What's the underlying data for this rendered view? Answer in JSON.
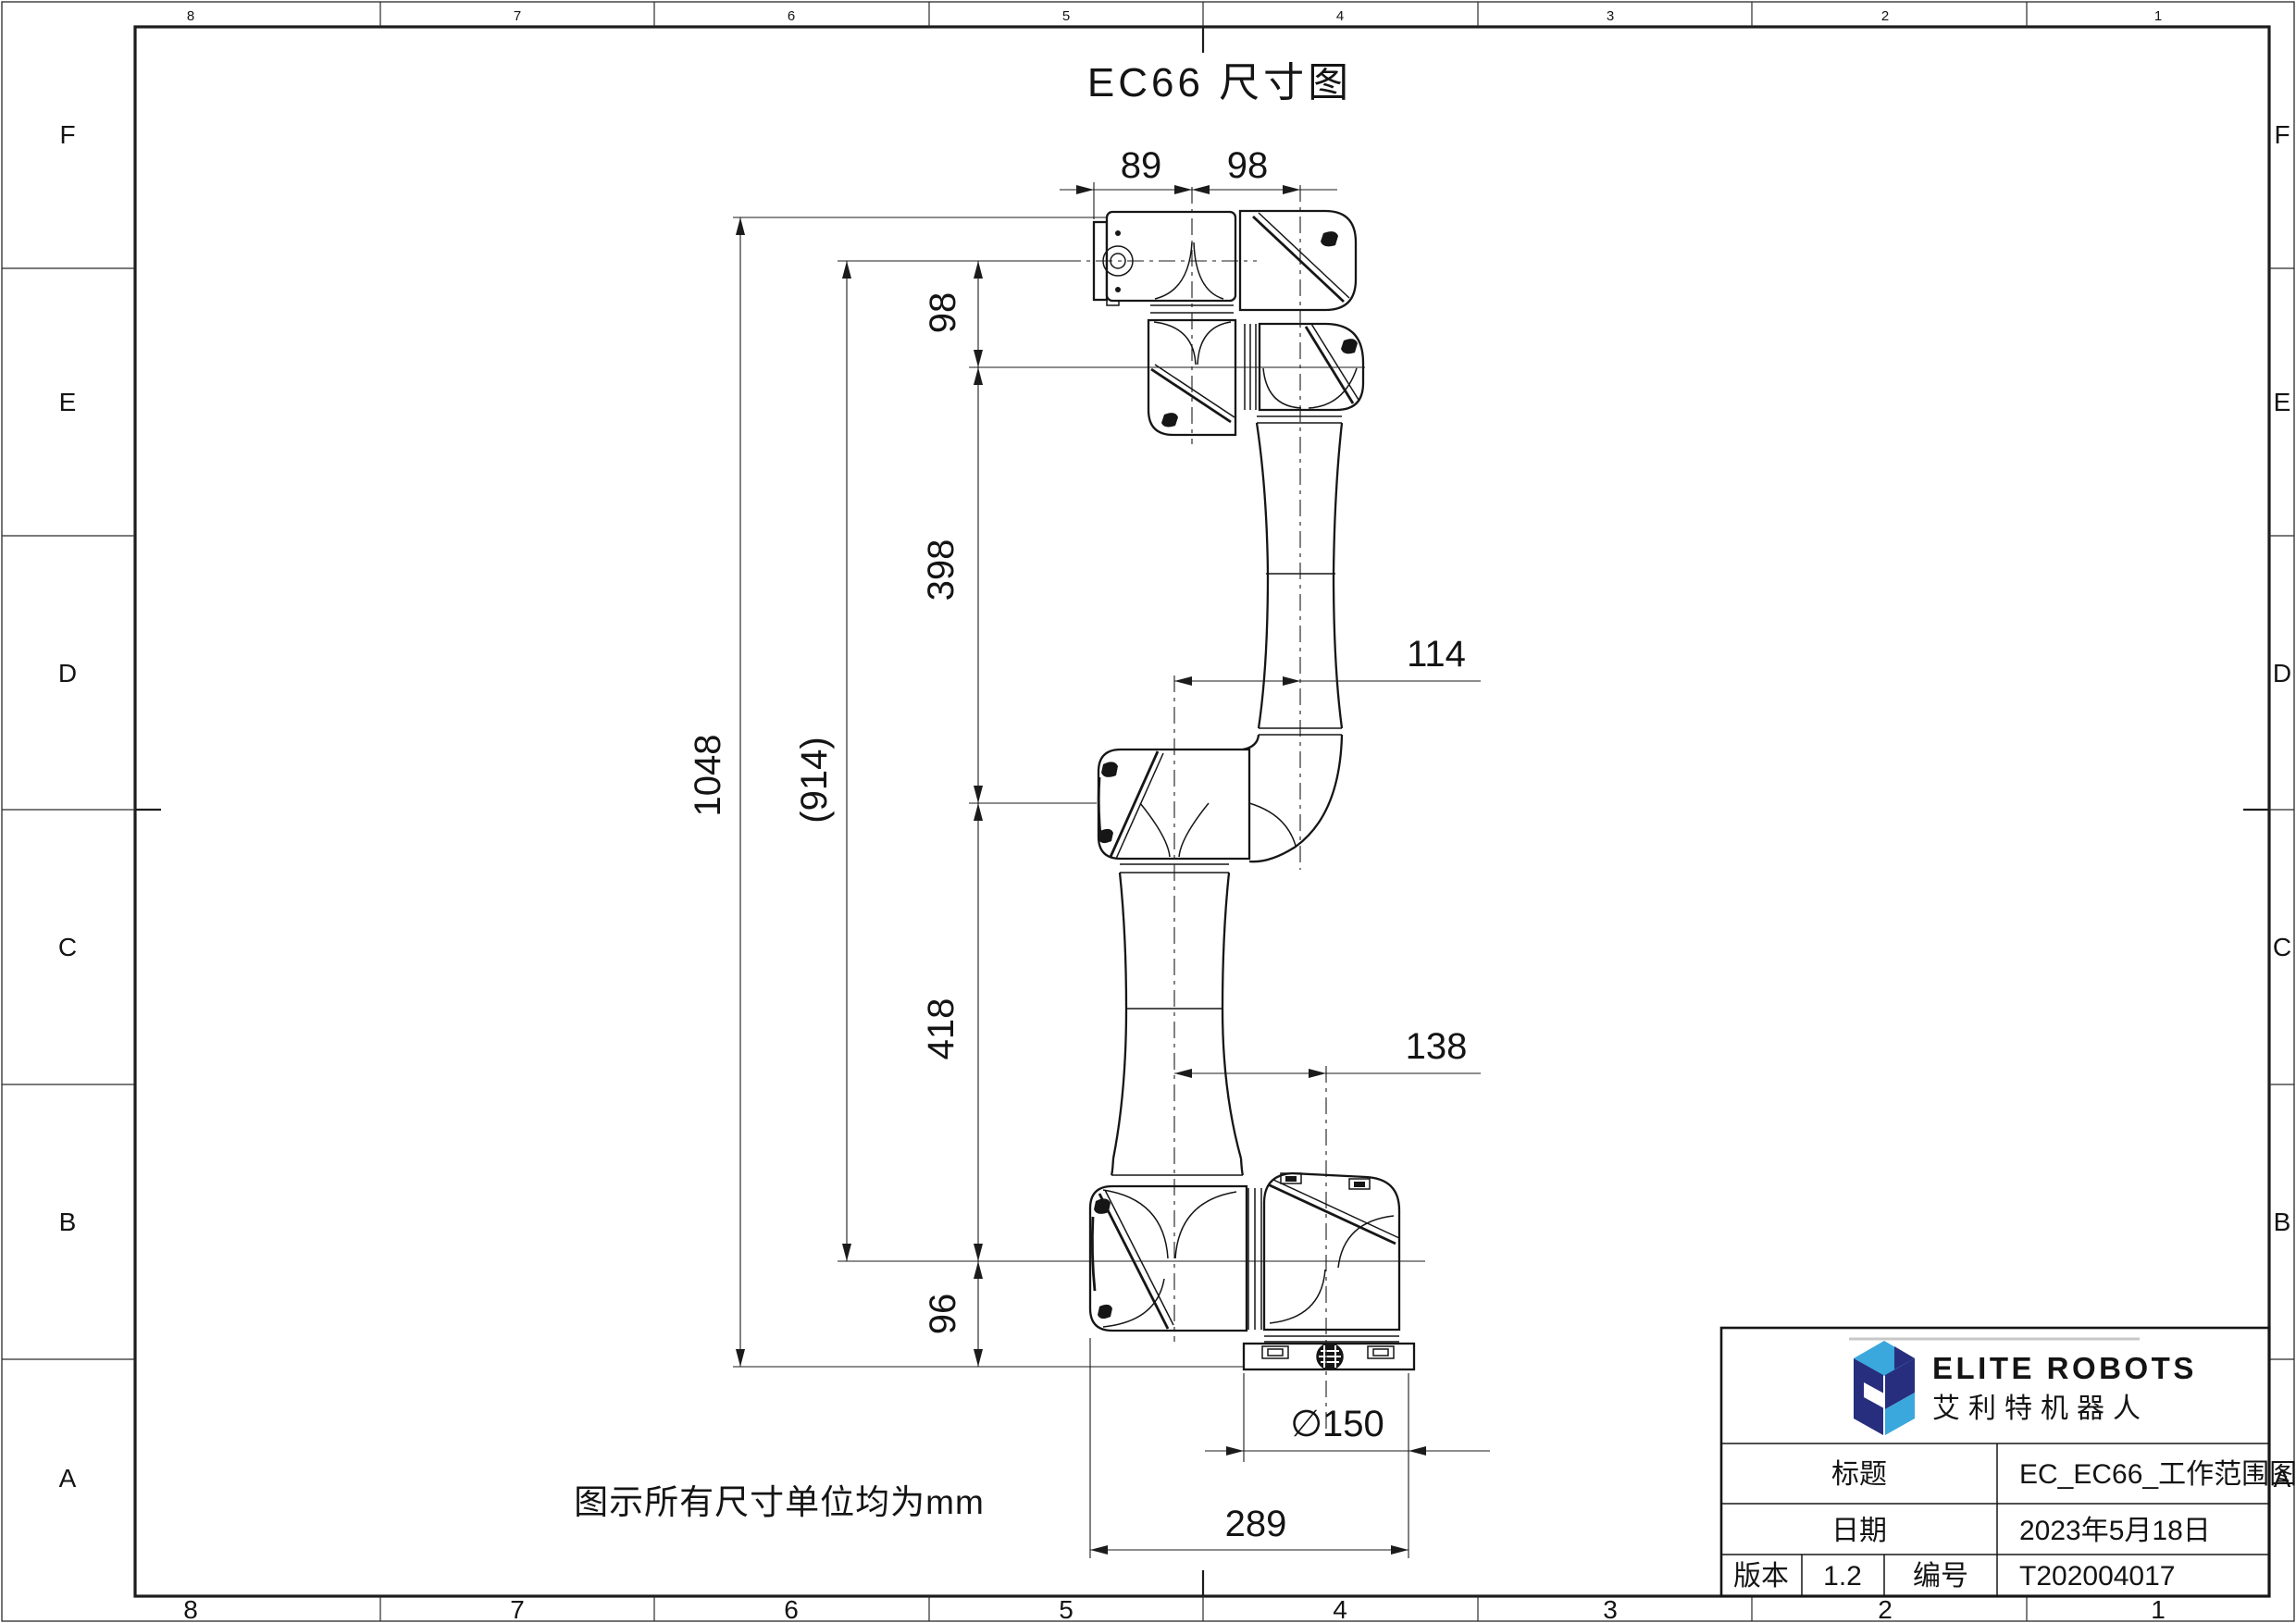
{
  "sheet": {
    "title": "EC66 尺寸图",
    "note": "图示所有尺寸单位均为mm"
  },
  "zones": {
    "top": [
      "8",
      "7",
      "6",
      "5",
      "4",
      "3",
      "2",
      "1"
    ],
    "bottom": [
      "8",
      "7",
      "6",
      "5",
      "4",
      "3",
      "2",
      "1"
    ],
    "left": [
      "F",
      "E",
      "D",
      "C",
      "B",
      "A"
    ],
    "right": [
      "F",
      "E",
      "D",
      "C",
      "B",
      "A"
    ]
  },
  "dimensions": {
    "top_width_1": "89",
    "top_width_2": "98",
    "wrist_offset": "98",
    "forearm_length": "398",
    "upper_arm_length": "418",
    "base_height": "96",
    "total_height": "1048",
    "flange_to_shoulder": "(914)",
    "elbow_offset": "114",
    "base_offset": "138",
    "base_diameter": "∅150",
    "base_width": "289"
  },
  "title_block": {
    "company_en": "ELITE ROBOTS",
    "company_cn": "艾利特机器人",
    "title_label": "标题",
    "title_value": "EC_EC66_工作范围图",
    "date_label": "日期",
    "date_value": "2023年5月18日",
    "version_label": "版本",
    "version_value": "1.2",
    "number_label": "编号",
    "number_value": "T202004017"
  },
  "colors": {
    "logo_dark": "#272e7d",
    "logo_light": "#3aa8dc",
    "line": "#1b1b1b"
  }
}
